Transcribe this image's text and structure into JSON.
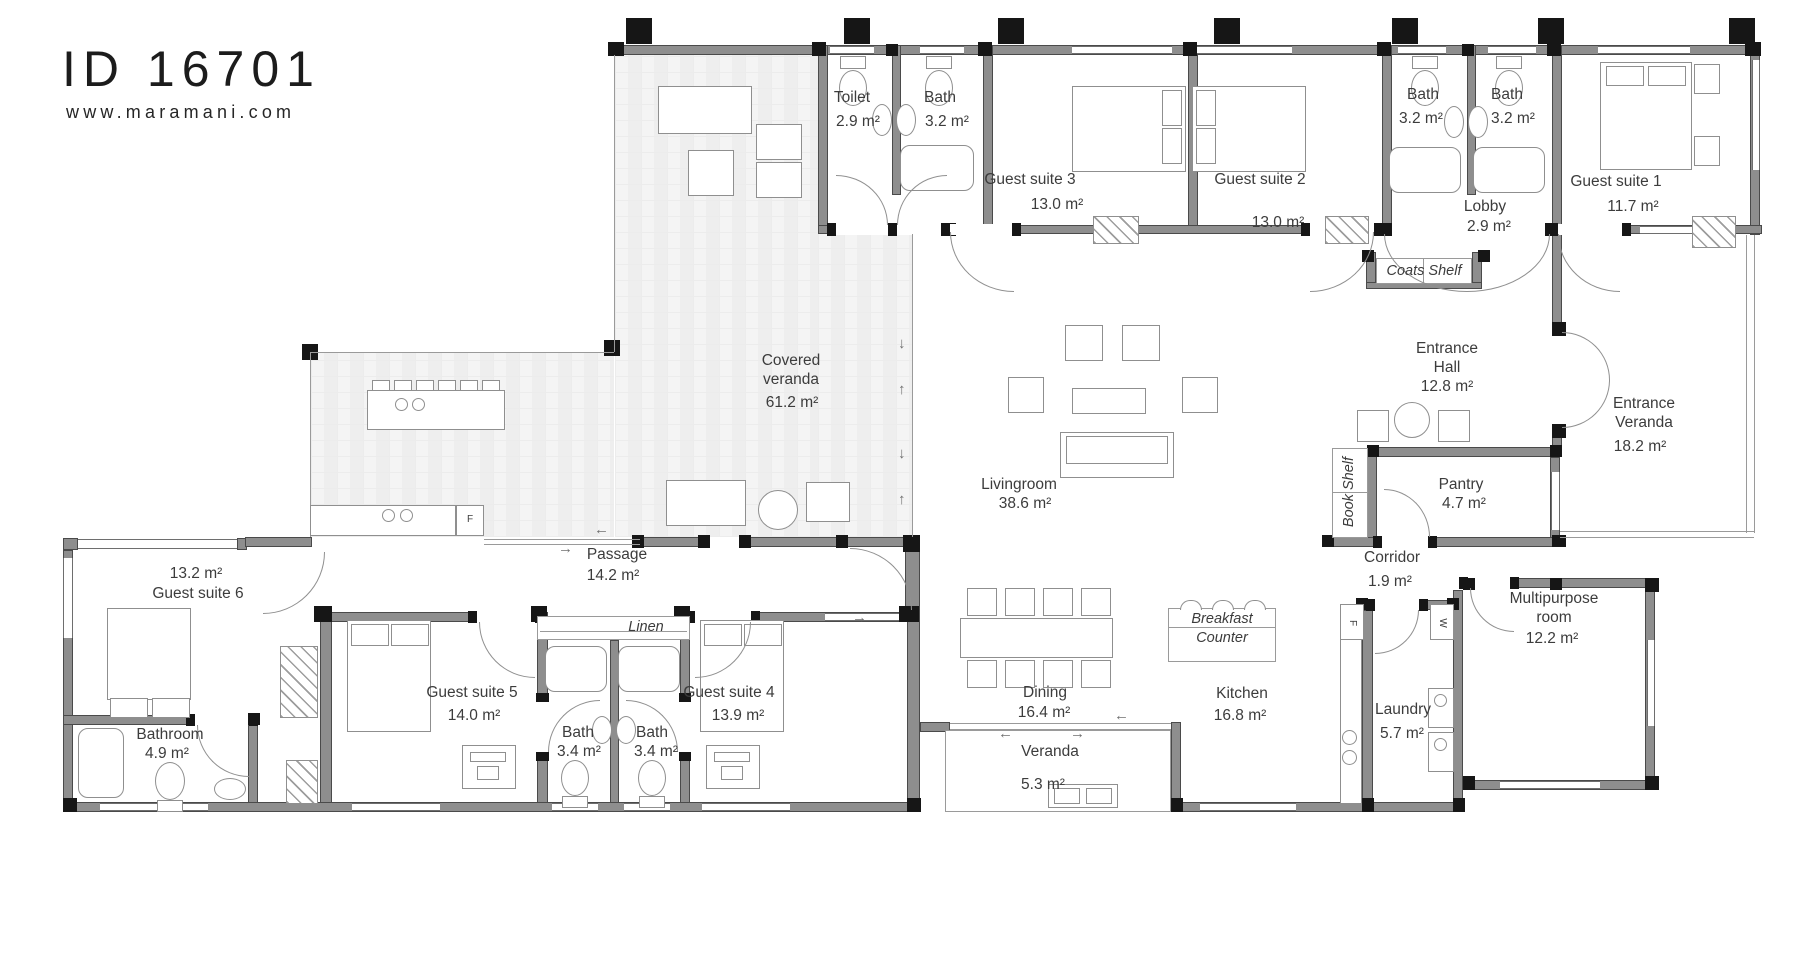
{
  "title": {
    "plan_id": "ID 16701",
    "website": "www.maramani.com"
  },
  "rooms": {
    "toilet": {
      "name": "Toilet",
      "area": "2.9 m²"
    },
    "bath_a": {
      "name": "Bath",
      "area": "3.2 m²"
    },
    "guest_suite_3": {
      "name": "Guest suite 3",
      "area": "13.0 m²"
    },
    "guest_suite_2": {
      "name": "Guest suite 2",
      "area": "13.0 m²"
    },
    "bath_b": {
      "name": "Bath",
      "area": "3.2 m²"
    },
    "bath_c": {
      "name": "Bath",
      "area": "3.2 m²"
    },
    "lobby": {
      "name": "Lobby",
      "area": "2.9 m²"
    },
    "guest_suite_1": {
      "name": "Guest suite 1",
      "area": "11.7 m²"
    },
    "covered_veranda": {
      "name": "Covered veranda",
      "area": "61.2 m²"
    },
    "entrance_hall": {
      "name": "Entrance Hall",
      "area": "12.8 m²"
    },
    "entrance_veranda": {
      "name": "Entrance Veranda",
      "area": "18.2 m²"
    },
    "livingroom": {
      "name": "Livingroom",
      "area": "38.6 m²"
    },
    "pantry": {
      "name": "Pantry",
      "area": "4.7 m²"
    },
    "corridor": {
      "name": "Corridor",
      "area": "1.9 m²"
    },
    "multipurpose_room": {
      "name": "Multipurpose room",
      "area": "12.2 m²"
    },
    "passage": {
      "name": "Passage",
      "area": "14.2 m²"
    },
    "guest_suite_6": {
      "name": "Guest suite 6",
      "area": "13.2 m²"
    },
    "guest_suite_5": {
      "name": "Guest suite 5",
      "area": "14.0 m²"
    },
    "guest_suite_4": {
      "name": "Guest suite 4",
      "area": "13.9 m²"
    },
    "bath_d": {
      "name": "Bath",
      "area": "3.4 m²"
    },
    "bath_e": {
      "name": "Bath",
      "area": "3.4 m²"
    },
    "bathroom": {
      "name": "Bathroom",
      "area": "4.9 m²"
    },
    "dining": {
      "name": "Dining",
      "area": "16.4 m²"
    },
    "kitchen": {
      "name": "Kitchen",
      "area": "16.8 m²"
    },
    "laundry": {
      "name": "Laundry",
      "area": "5.7 m²"
    },
    "veranda": {
      "name": "Veranda",
      "area": "5.3 m²"
    }
  },
  "fixtures": {
    "coats_shelf": "Coats Shelf",
    "book_shelf": "Book Shelf",
    "linen": "Linen",
    "breakfast_line1": "Breakfast",
    "breakfast_line2": "Counter",
    "fridge_marker": "F",
    "washer_marker": "W"
  },
  "symbols": {
    "arrow_up": "↑",
    "arrow_down": "↓",
    "arrow_left": "←",
    "arrow_right": "→"
  },
  "colors": {
    "wall": "#8e8e8e",
    "post": "#161616",
    "line": "#9a9a9a",
    "text": "#3c3c3c"
  }
}
